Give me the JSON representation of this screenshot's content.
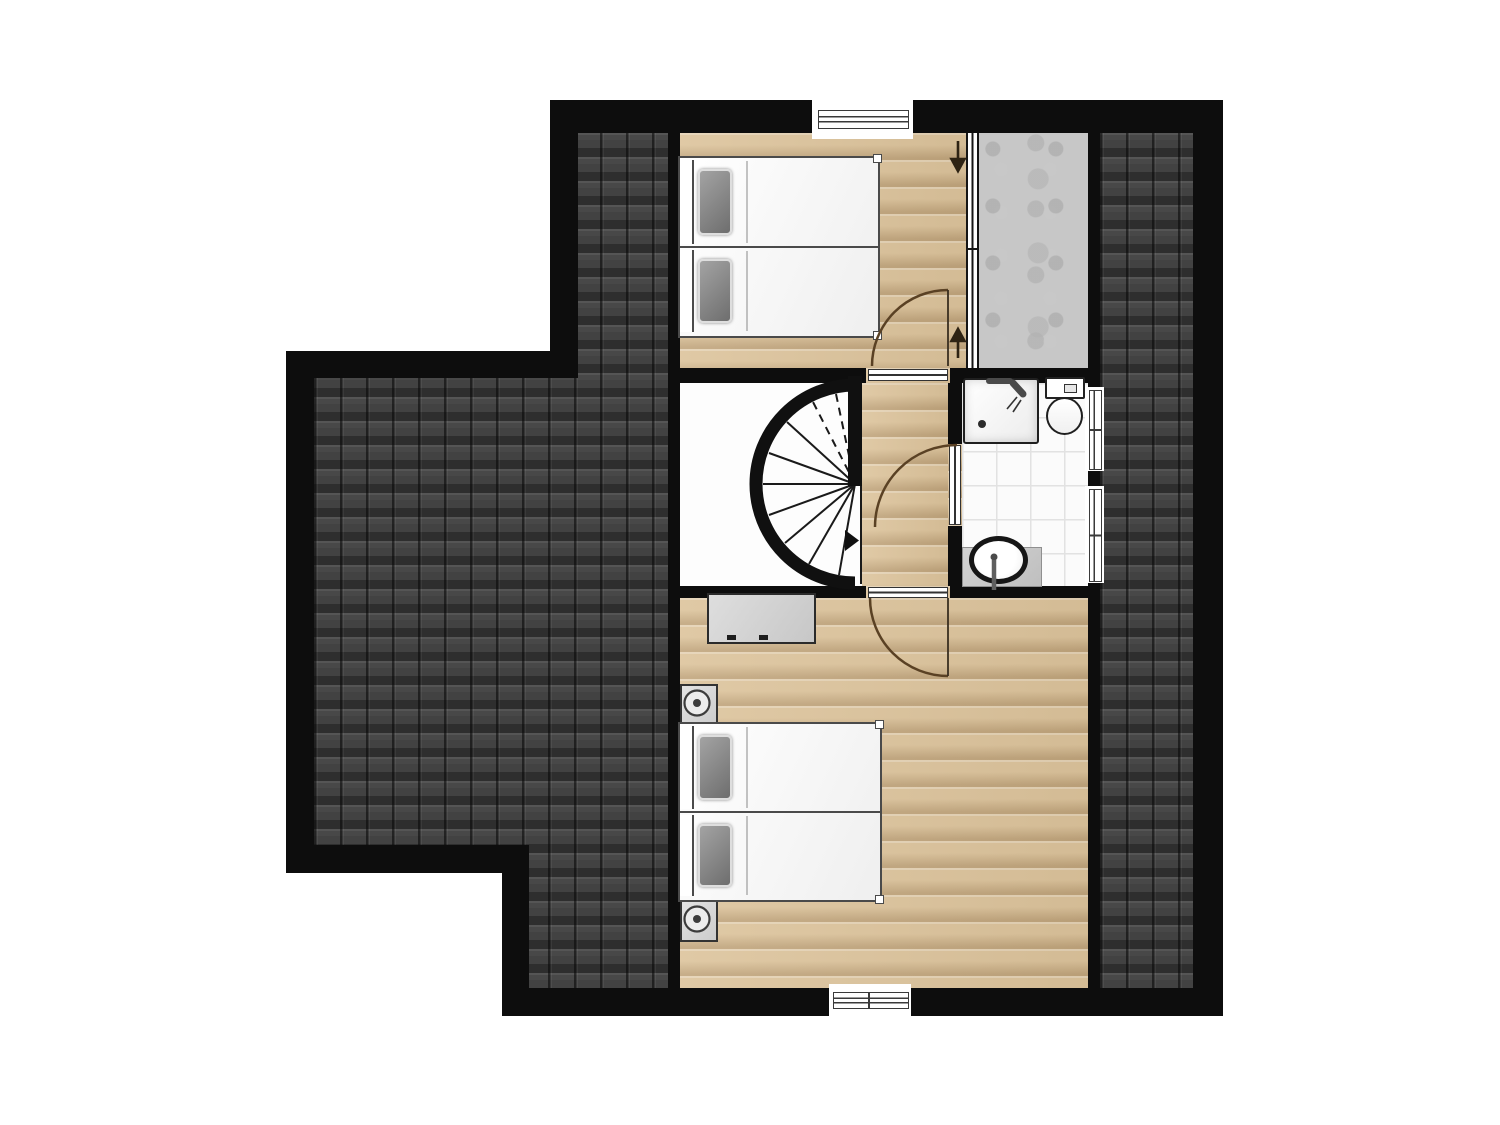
{
  "document": {
    "kind": "architectural-floor-plan",
    "storey": "attic-floor",
    "visible_text": [],
    "canvas": {
      "width": 1500,
      "height": 1125,
      "background": "#ffffff"
    }
  },
  "plan": {
    "wall_color": "#0d0d0d",
    "colors": {
      "roof_tiles": "#424242",
      "wood_floor": "#dcc39b",
      "bathroom_tile": "#fbfbfb",
      "storage_concrete": "#c7c7c7",
      "stairwell_floor": "#fdfdfd",
      "door_swing_arc": "#5a4124",
      "direction_arrow": "#2e2313",
      "pillow_gray": "#8a8a8a",
      "furniture_gray": "#d2d2d2"
    },
    "rooms": [
      {
        "id": "roof-left",
        "finish": "roof-tiles"
      },
      {
        "id": "roof-right",
        "finish": "roof-tiles"
      },
      {
        "id": "bedroom-top",
        "finish": "wood",
        "furniture": [
          "single-bed",
          "single-bed"
        ]
      },
      {
        "id": "storage-loft",
        "finish": "concrete"
      },
      {
        "id": "stairwell",
        "finish": "white",
        "feature": "spiral-staircase"
      },
      {
        "id": "landing",
        "finish": "wood"
      },
      {
        "id": "bathroom",
        "finish": "tile",
        "fixtures": [
          "shower",
          "toilet",
          "washbasin"
        ]
      },
      {
        "id": "bedroom-bottom",
        "finish": "wood",
        "furniture": [
          "double-bed",
          "nightstand",
          "nightstand",
          "sideboard"
        ]
      }
    ],
    "openings": {
      "windows": [
        "top-wall-window",
        "bottom-wall-window",
        "bathroom-window-upper",
        "bathroom-window-lower"
      ],
      "doors": [
        "bedroom-top-door",
        "bedroom-bottom-door",
        "bathroom-door"
      ],
      "glass_partition": "storage-sliding-partition",
      "direction_arrows": [
        "arrow-down",
        "arrow-up"
      ]
    }
  }
}
